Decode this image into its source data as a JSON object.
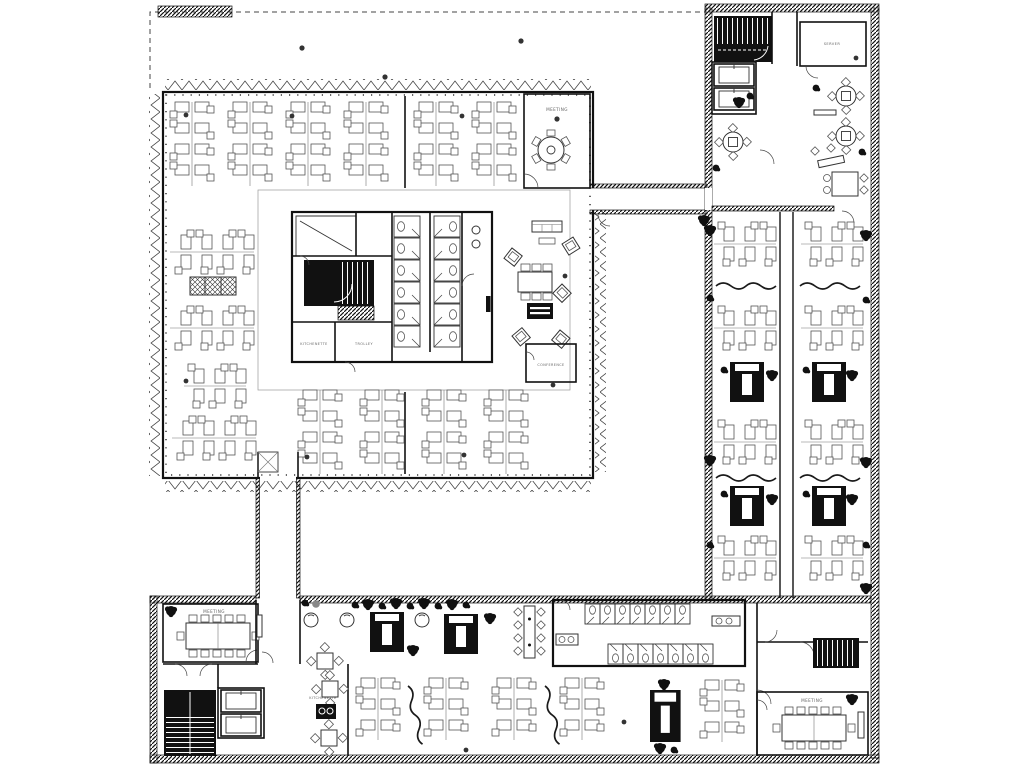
{
  "palette": {
    "background": "#ffffff",
    "linework": "#1a1a1a",
    "wall_fill": "#111111",
    "furniture_line": "#555555",
    "label_text": "#666666"
  },
  "drawing": {
    "type": "architectural-floor-plan",
    "style": "black-and-white CAD linework"
  },
  "rooms": {
    "meeting_top": {
      "label": "MEETING"
    },
    "server": {
      "label": "SERVER"
    },
    "kitchenette_core": {
      "label": "KITCHENETTE"
    },
    "trolley": {
      "label": "TROLLEY"
    },
    "conference": {
      "label": "CONFERENCE"
    },
    "meeting_bottom_left": {
      "label": "MEETING"
    },
    "kitchenette_bottom": {
      "label": "KITCHENETTE"
    },
    "meeting_bottom_right": {
      "label": "MEETING"
    }
  }
}
